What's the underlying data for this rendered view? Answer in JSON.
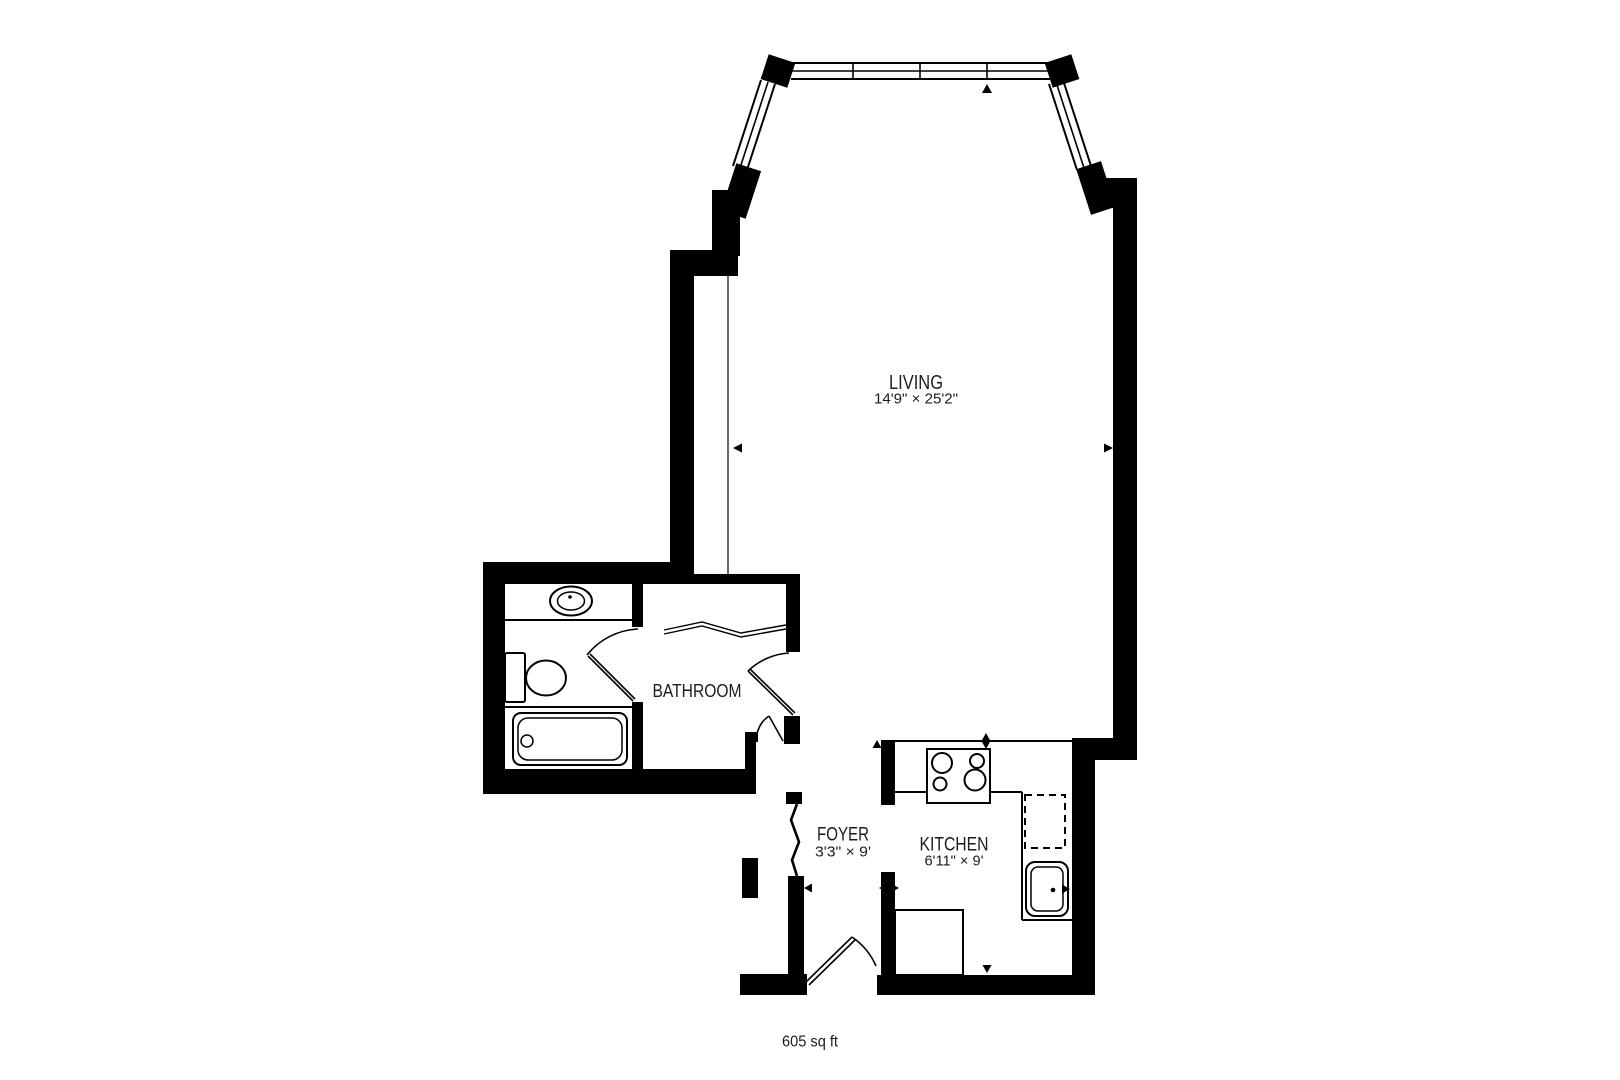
{
  "plan": {
    "type": "apartment-floor-plan",
    "area_label": "605 sq ft",
    "rooms": {
      "living": {
        "name": "LIVING",
        "dims": "14'9\" × 25'2\""
      },
      "bathroom": {
        "name": "BATHROOM",
        "dims": ""
      },
      "foyer": {
        "name": "FOYER",
        "dims": "3'3\" × 9'"
      },
      "kitchen": {
        "name": "KITCHEN",
        "dims": "6'11\" × 9'"
      }
    },
    "fixtures": [
      "bay-window",
      "bathroom-sink",
      "toilet",
      "bathtub",
      "vanity-counter",
      "hall-closet",
      "foyer-closet",
      "stove-4-burner",
      "dishwasher-dashed",
      "kitchen-sink",
      "kitchen-counter",
      "entry-door",
      "bathroom-door",
      "hall-door"
    ],
    "colors": {
      "walls": "#000000",
      "background": "#ffffff",
      "text": "#1c1c1c"
    }
  }
}
